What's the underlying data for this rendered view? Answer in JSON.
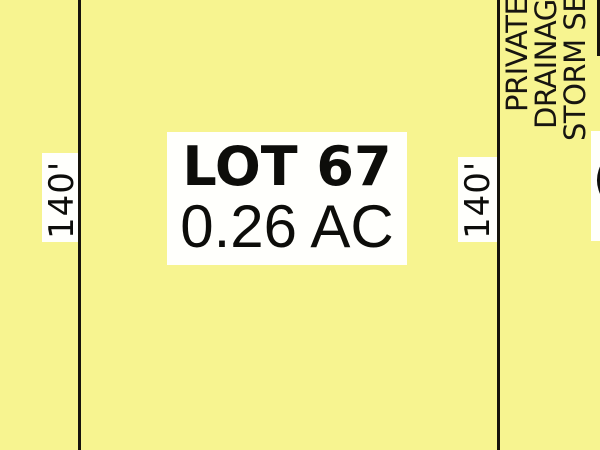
{
  "map": {
    "background_color": "#F7F490",
    "line_color": "#16130C",
    "lot": {
      "number": "LOT 67",
      "area": "0.26 AC"
    },
    "dimensions": {
      "left": "140'",
      "right": "140'"
    },
    "easement_label": {
      "line1": "PRIVATE",
      "line2": "DRAINAGE",
      "line3": "STORM SE"
    },
    "edge_fragment": "("
  }
}
